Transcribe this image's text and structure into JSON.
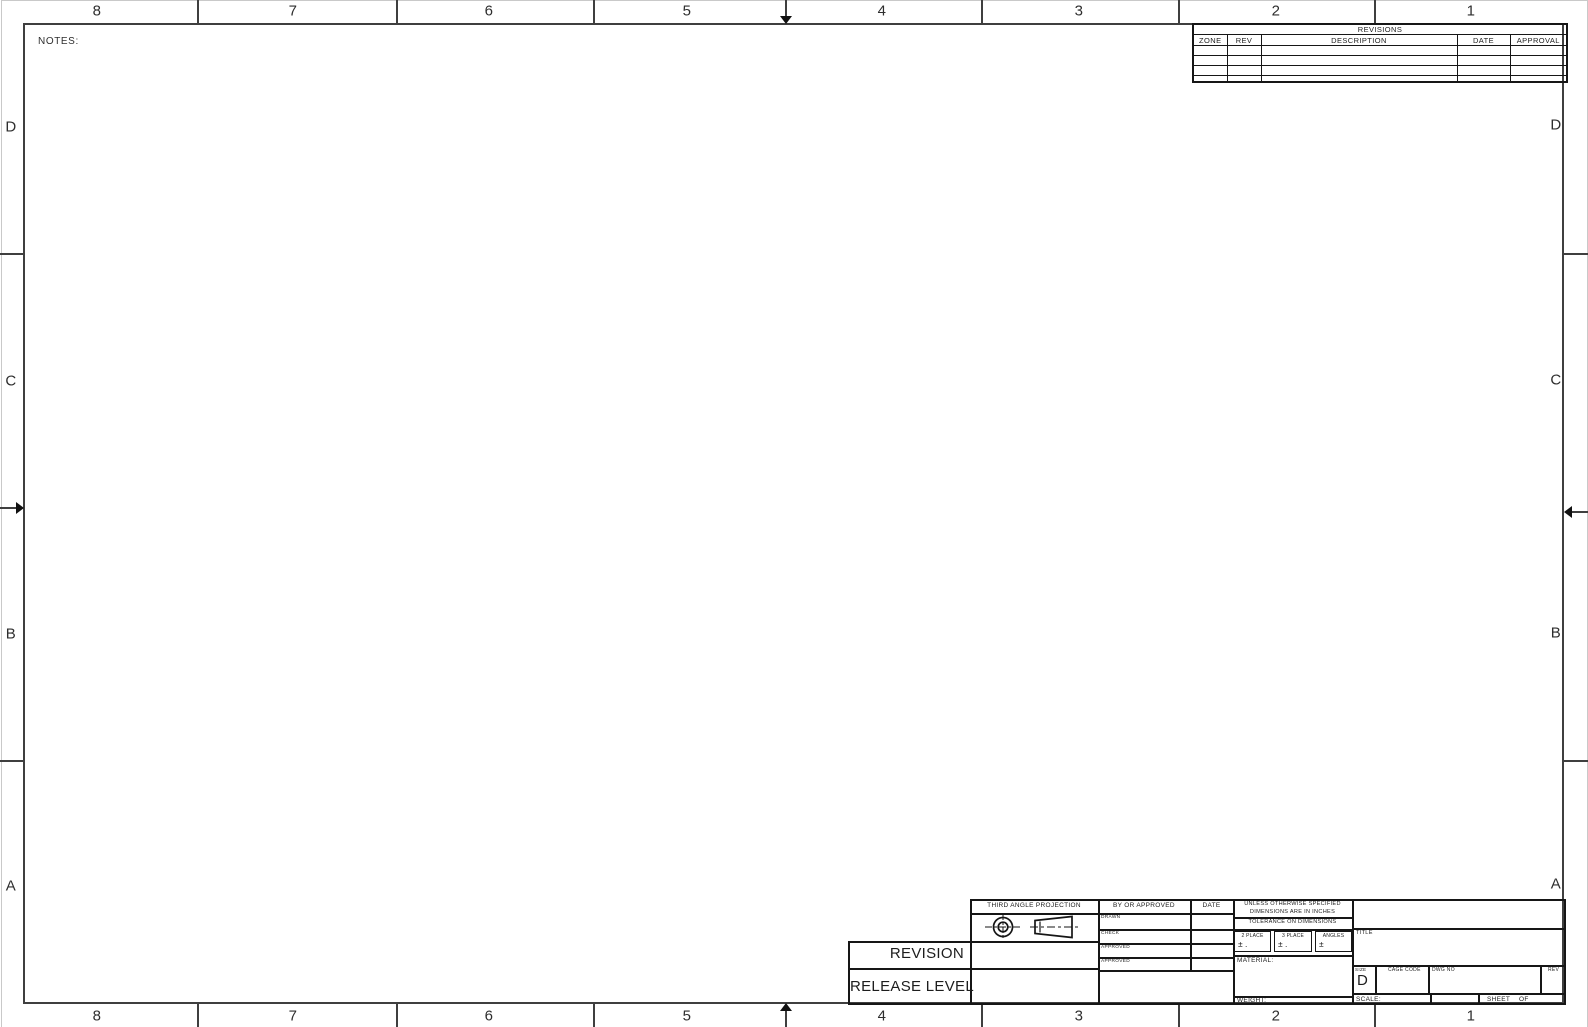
{
  "sheet": {
    "notes_label": "NOTES:",
    "zone_columns": [
      "8",
      "7",
      "6",
      "5",
      "4",
      "3",
      "2",
      "1"
    ],
    "zone_rows": [
      "D",
      "C",
      "B",
      "A"
    ]
  },
  "revisions": {
    "title": "REVISIONS",
    "columns": [
      "ZONE",
      "REV",
      "DESCRIPTION",
      "DATE",
      "APPROVAL"
    ]
  },
  "titleblock": {
    "revision_label": "REVISION",
    "release_level_label": "RELEASE LEVEL",
    "third_angle_projection_label": "THIRD ANGLE PROJECTION",
    "by_or_approved_label": "BY OR APPROVED",
    "date_label": "DATE",
    "signoff_rows": [
      "DRAWN",
      "CHECK",
      "APPROVED",
      "APPROVED"
    ],
    "unless_line1": "UNLESS OTHERWISE SPECIFIED",
    "unless_line2": "DIMENSIONS ARE IN INCHES",
    "tolerance_heading": "TOLERANCE ON DIMENSIONS",
    "tol_boxes": [
      {
        "label": "2 PLACE",
        "value": "± ."
      },
      {
        "label": "3 PLACE",
        "value": "± ."
      },
      {
        "label": "ANGLES",
        "value": "±"
      }
    ],
    "material_label": "MATERIAL:",
    "weight_label": "WEIGHT:",
    "title_label": "TITLE",
    "size_label": "SIZE",
    "size_value": "D",
    "cage_code_label": "CAGE CODE",
    "dwg_no_label": "DWG NO",
    "rev_label": "REV",
    "scale_label": "SCALE:",
    "sheet_label": "SHEET",
    "of_label": "OF"
  }
}
